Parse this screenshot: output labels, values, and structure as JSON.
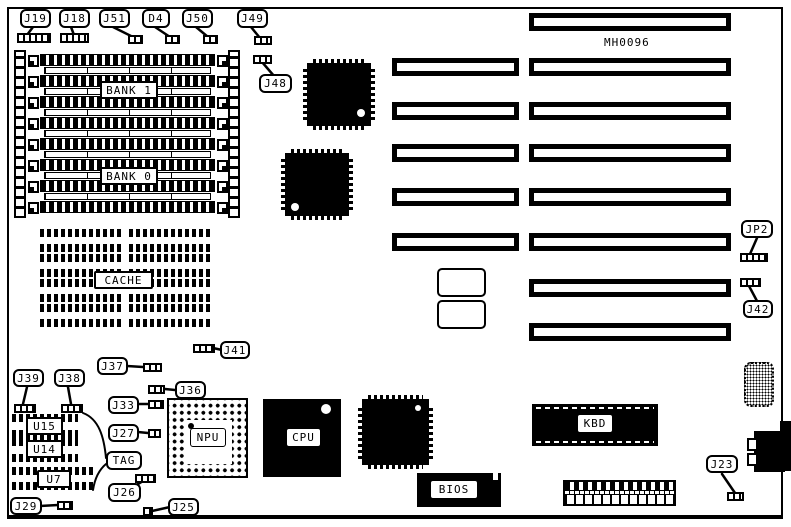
{
  "board": {
    "part_number": "MH0096"
  },
  "labels": {
    "j19": "J19",
    "j18": "J18",
    "j51": "J51",
    "d4": "D4",
    "j50": "J50",
    "j49": "J49",
    "j48": "J48",
    "jp2": "JP2",
    "j42": "J42",
    "j41": "J41",
    "j37": "J37",
    "j36": "J36",
    "j33": "J33",
    "j27": "J27",
    "j26": "J26",
    "j25": "J25",
    "j29": "J29",
    "j39": "J39",
    "j38": "J38",
    "j23": "J23",
    "tag": "TAG",
    "bank1": "BANK 1",
    "bank0": "BANK 0",
    "cache": "CACHE",
    "npu": "NPU",
    "cpu": "CPU",
    "bios": "BIOS",
    "kbd": "KBD",
    "u15": "U15",
    "u14": "U14",
    "u7": "U7"
  },
  "colors": {
    "ink": "#000000",
    "paper": "#ffffff"
  }
}
